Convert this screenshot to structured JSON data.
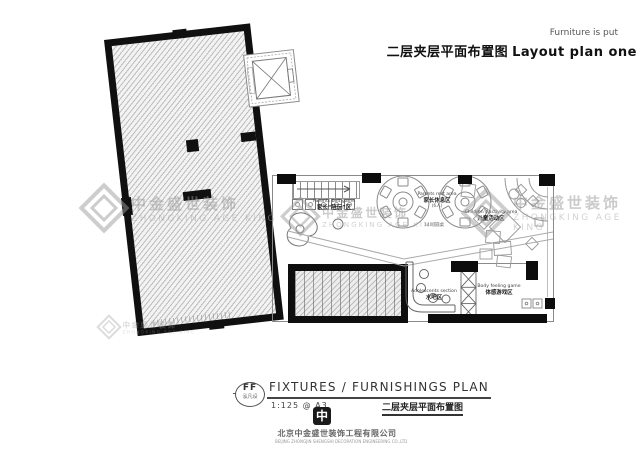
{
  "header": {
    "note": "Furniture is put",
    "title_zh": "二层夹层平面布置图",
    "title_en": "Layout plan one"
  },
  "watermark": {
    "line1": "中金盛世装饰",
    "line2": "ZHONGKING AGE KING"
  },
  "plan": {
    "areas": {
      "parents_play": {
        "en": "Parents belt game",
        "zh": "家长“陪玩”区"
      },
      "parents_rest": {
        "en": "Parents rest area",
        "zh": "家长休息区",
        "note": "(6人)"
      },
      "table_note": "1400圆桌",
      "children": {
        "en": "Children's activity area",
        "zh": "儿童活动区"
      },
      "bar": {
        "en": "Adolescents section",
        "zh": "水吧区"
      },
      "body_game": {
        "en": "Body feeling game",
        "zh": "体感游戏区"
      }
    }
  },
  "title_block": {
    "code": "FF",
    "code_sub": "泓凡设",
    "title": "FIXTURES / FURNISHINGS PLAN",
    "scale": "1:125 @ A3",
    "title_zh": "二层夹层平面布置图",
    "logo_glyph": "中",
    "company_zh": "北京中金盛世装饰工程有限公司",
    "company_en": "BEIJING ZHONGJIN SHENGSHI DECORATION ENGINEERING CO.,LTD"
  },
  "colors": {
    "wall": "#101010",
    "hatch_line": "#bcbcbc",
    "watermark": "#9c9c9c"
  }
}
